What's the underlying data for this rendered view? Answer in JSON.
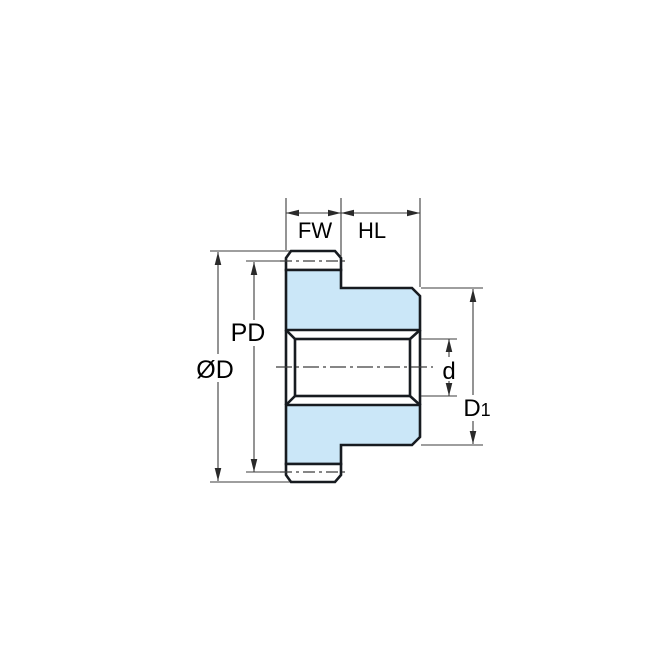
{
  "diagram": {
    "kind": "gear-cross-section-dimension-drawing",
    "labels": {
      "face_width": "FW",
      "hub_length": "HL",
      "pitch_diameter": "PD",
      "outside_diameter": "ØD",
      "bore_diameter": "d",
      "hub_diameter_main": "D",
      "hub_diameter_sub": "1"
    },
    "colors": {
      "part_fill": "#cbe7f8",
      "part_outline": "#171b20",
      "dimension_line": "#3d3d3d",
      "arrow_fill": "#2a2a2a",
      "label_text": "#000000",
      "background": "#ffffff"
    }
  }
}
